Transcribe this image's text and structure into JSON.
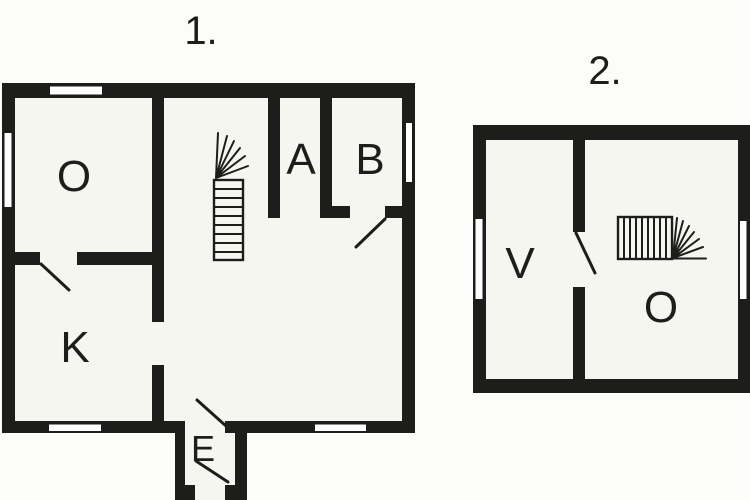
{
  "colors": {
    "wall": "#1d1d1b",
    "floor": "#f6f6f1",
    "background": "#fcfcfa",
    "window_fill": "#ffffff",
    "line": "#1d1d1b"
  },
  "plans": [
    {
      "number_label": "1.",
      "rooms": [
        {
          "label": "O"
        },
        {
          "label": "K"
        },
        {
          "label": "A"
        },
        {
          "label": "B"
        },
        {
          "label": "E"
        }
      ]
    },
    {
      "number_label": "2.",
      "rooms": [
        {
          "label": "V"
        },
        {
          "label": "O"
        }
      ]
    }
  ]
}
